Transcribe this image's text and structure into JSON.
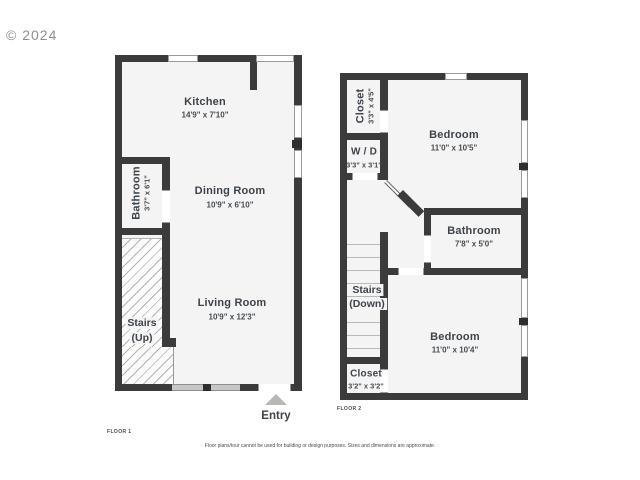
{
  "watermark": "© 2024",
  "floor1": {
    "label": "FLOOR 1",
    "entry_label": "Entry",
    "rooms": {
      "kitchen": {
        "name": "Kitchen",
        "dims": "14'9\" x 7'10\""
      },
      "dining": {
        "name": "Dining Room",
        "dims": "10'9\" x 6'10\""
      },
      "bathroom": {
        "name": "Bathroom",
        "dims": "3'7\" x 6'1\""
      },
      "living": {
        "name": "Living Room",
        "dims": "10'9\" x 12'3\""
      },
      "stairs": {
        "line1": "Stairs",
        "line2": "(Up)"
      }
    }
  },
  "floor2": {
    "label": "FLOOR 2",
    "rooms": {
      "closet_top": {
        "name": "Closet",
        "dims": "3'3\" x 4'5\""
      },
      "bedroom_top": {
        "name": "Bedroom",
        "dims": "11'0\" x 10'5\""
      },
      "wd": {
        "name": "W / D",
        "dims": "3'3\" x 3'1\""
      },
      "bathroom": {
        "name": "Bathroom",
        "dims": "7'8\" x 5'0\""
      },
      "stairs": {
        "line1": "Stairs",
        "line2": "(Down)"
      },
      "bedroom_bottom": {
        "name": "Bedroom",
        "dims": "11'0\" x 10'4\""
      },
      "closet_bottom": {
        "name": "Closet",
        "dims": "3'2\" x 3'2\""
      }
    }
  },
  "disclaimer": "Floor plans/tour cannot be used for building or design purposes. Sizes and dimensions are approximate.",
  "colors": {
    "wall": "#3b3b3b",
    "room_fill": "#f4f4f4",
    "text": "#3e444a",
    "watermark": "#8f8f8f"
  }
}
